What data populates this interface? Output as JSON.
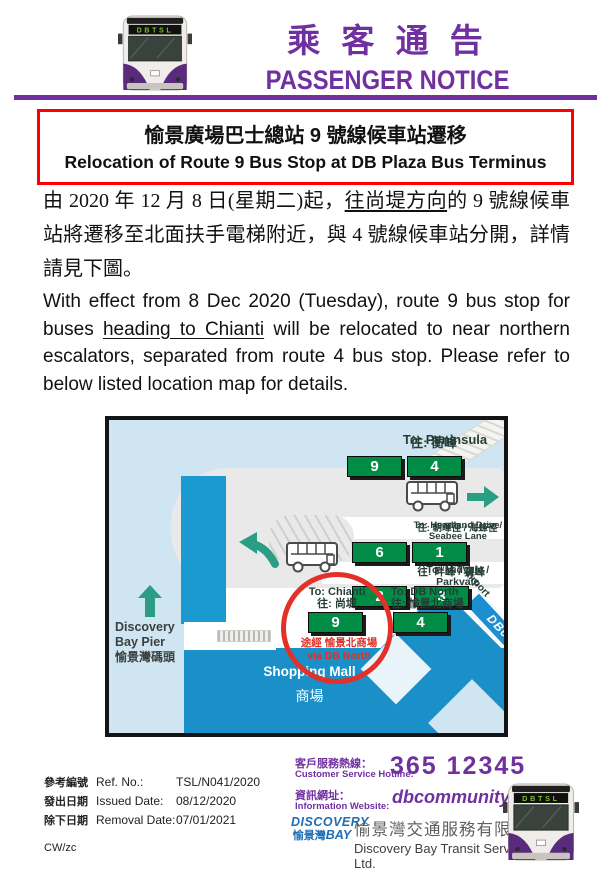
{
  "bus_display": "DBTSL",
  "header": {
    "title_cjk": "乘 客 通 告",
    "title_en": "PASSENGER NOTICE"
  },
  "notice_title": {
    "line1": "愉景廣場巴士總站 9 號線候車站遷移",
    "line2": "Relocation of Route 9 Bus Stop at DB Plaza Bus Terminus"
  },
  "body": {
    "cjk": {
      "pre": "由 2020 年 12 月 8 日(星期二)起，",
      "underline": "往尚堤方向",
      "post": "的 9 號線候車站將遷移至北面扶手電梯附近，與 4 號線候車站分開，詳情請見下圖。"
    },
    "en": {
      "pre": "With effect from 8 Dec 2020 (Tuesday), route 9 bus stop for buses ",
      "underline": "heading to Chianti",
      "post": " will be relocated to near northern escalators, separated from route 4 bus stop.  Please refer to below listed location map for details."
    }
  },
  "map": {
    "stops": [
      {
        "label_en": "To: Peninsula",
        "label_cjk": "往: 蘅峰",
        "routes": [
          "9",
          "4"
        ]
      },
      {
        "label_en": "To: Headland Drive/ Seabee Lane",
        "label_cjk": "往: 朝暉徑 / 海蜂徑",
        "routes": [
          "6",
          "1"
        ]
      },
      {
        "label_en": "To: Midvale / Parkvale",
        "label_cjk": "往: 畔峰 / 寶峰",
        "routes": [
          "2",
          "3"
        ]
      },
      {
        "label_en": "To: Chianti",
        "label_cjk": "往: 尚堤",
        "routes": [
          "9"
        ],
        "note_cjk": "途經 愉景北商場",
        "note_en": "via DB North"
      },
      {
        "label_en": "To: DB North",
        "label_cjk": "往: 愉景北商場",
        "routes": [
          "4"
        ]
      }
    ],
    "pier": {
      "line1": "Discovery",
      "line2": "Bay Pier",
      "line3": "愉景灣碼頭"
    },
    "mall": {
      "en": "Shopping Mall",
      "cjk": "商場"
    },
    "airport_label": "To: Airport",
    "road_ribbon": "DB0"
  },
  "footer": {
    "ref": {
      "cjk": "參考編號",
      "en": "Ref. No.:",
      "value": "TSL/N041/2020"
    },
    "issued": {
      "cjk": "發出日期",
      "en": "Issued Date:",
      "value": "08/12/2020"
    },
    "removal": {
      "cjk": "除下日期",
      "en": "Removal Date:",
      "value": "07/01/2021"
    },
    "initials": "CW/zc",
    "hotline_label_cjk": "客戶服務熱線：",
    "hotline_label_en": "Customer Service Hotline:",
    "hotline_value": "365 12345",
    "website_label_cjk": "資訊網址：",
    "website_label_en": "Information Website:",
    "website_value": "dbcommunity.hk",
    "logo": {
      "top": "DISCOVERY",
      "cjk": "愉景灣",
      "bay": "BAY"
    },
    "company_cjk": "愉景灣交通服務有限公司",
    "company_en": "Discovery Bay Transit Services Ltd."
  },
  "colors": {
    "brand_purple": "#7030a0",
    "alert_red": "#ff0000",
    "circle_red": "#e23128",
    "route_green": "#018c46",
    "map_teal": "#2a9d84",
    "mall_blue": "#1b8fc8",
    "water_blue": "#cfe6f2",
    "logo_blue": "#1e6db5"
  }
}
